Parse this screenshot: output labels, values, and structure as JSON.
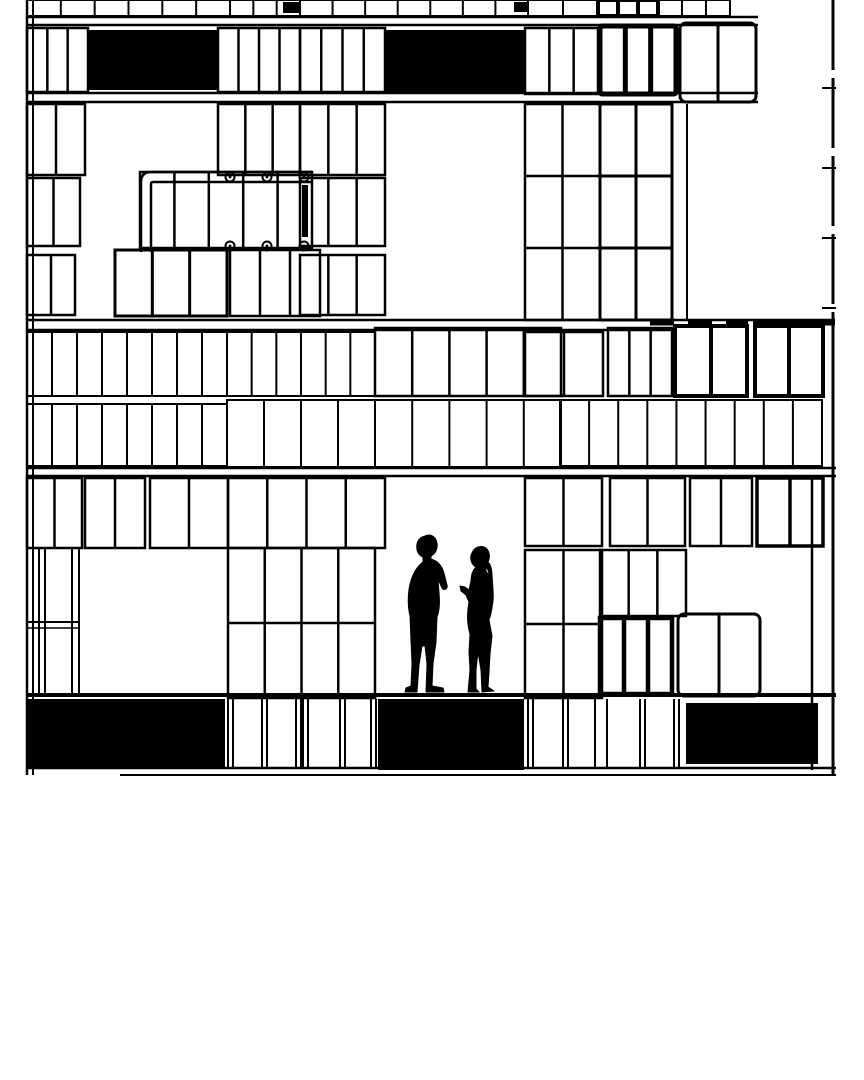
{
  "canvas": {
    "width": 864,
    "height": 1080,
    "paper_color": "#ffffff",
    "ink_color": "#000000"
  },
  "drawing": {
    "kind": "architectural-elevation",
    "black_panels": [
      [
        88,
        30,
        130,
        60
      ],
      [
        385,
        30,
        140,
        62
      ],
      [
        283,
        2,
        16,
        11
      ],
      [
        514,
        2,
        15,
        10
      ],
      [
        302,
        185,
        6,
        52
      ],
      [
        27,
        699,
        198,
        69
      ],
      [
        378,
        699,
        146,
        71
      ],
      [
        686,
        703,
        132,
        61
      ]
    ],
    "window_grids": [
      [
        27,
        0,
        203,
        16,
        6,
        1,
        2,
        0
      ],
      [
        230,
        0,
        70,
        16,
        3,
        1,
        2,
        0
      ],
      [
        300,
        0,
        228,
        16,
        7,
        1,
        2,
        0
      ],
      [
        528,
        0,
        70,
        16,
        2,
        1,
        2,
        0
      ],
      [
        598,
        0,
        60,
        16,
        3,
        1,
        4,
        0
      ],
      [
        658,
        0,
        72,
        16,
        3,
        1,
        2,
        0
      ],
      [
        27,
        28,
        61,
        64,
        3,
        1,
        2.5,
        0
      ],
      [
        218,
        28,
        82,
        64,
        4,
        1,
        2.5,
        0
      ],
      [
        300,
        28,
        85,
        64,
        4,
        1,
        2.5,
        0
      ],
      [
        525,
        28,
        73,
        66,
        3,
        1,
        2.5,
        0
      ],
      [
        600,
        26,
        76,
        68,
        3,
        1,
        5,
        2
      ],
      [
        680,
        23,
        76,
        79,
        2,
        1,
        3,
        6
      ],
      [
        525,
        104,
        75,
        216,
        2,
        3,
        2.5,
        0
      ],
      [
        600,
        104,
        72,
        216,
        2,
        3,
        3,
        0
      ],
      [
        27,
        104,
        58,
        71,
        2,
        1,
        2.5,
        0
      ],
      [
        218,
        104,
        82,
        71,
        3,
        1,
        2.5,
        0
      ],
      [
        300,
        104,
        85,
        71,
        3,
        1,
        2.5,
        0
      ],
      [
        27,
        178,
        53,
        68,
        2,
        1,
        2.5,
        0
      ],
      [
        140,
        172,
        172,
        76,
        5,
        1,
        2.5,
        0
      ],
      [
        300,
        178,
        85,
        68,
        3,
        1,
        2.5,
        0
      ],
      [
        27,
        255,
        48,
        60,
        2,
        1,
        2.5,
        0
      ],
      [
        115,
        250,
        112,
        66,
        3,
        1,
        3,
        0
      ],
      [
        230,
        250,
        90,
        66,
        3,
        1,
        2.5,
        0
      ],
      [
        300,
        255,
        85,
        60,
        3,
        1,
        2.5,
        0
      ],
      [
        27,
        332,
        200,
        64,
        8,
        1,
        2,
        0
      ],
      [
        227,
        332,
        148,
        64,
        6,
        1,
        2,
        0
      ],
      [
        375,
        328,
        186,
        68,
        5,
        1,
        2.5,
        0
      ],
      [
        525,
        332,
        78,
        64,
        2,
        1,
        2.5,
        0
      ],
      [
        608,
        328,
        64,
        68,
        3,
        1,
        2.5,
        0
      ],
      [
        675,
        326,
        72,
        70,
        2,
        1,
        4,
        0
      ],
      [
        755,
        326,
        68,
        70,
        2,
        1,
        4,
        0
      ],
      [
        27,
        404,
        200,
        62,
        8,
        1,
        2,
        0
      ],
      [
        227,
        400,
        148,
        67,
        4,
        1,
        2,
        0
      ],
      [
        375,
        400,
        186,
        67,
        5,
        1,
        2,
        0
      ],
      [
        560,
        400,
        262,
        66,
        9,
        1,
        2,
        0
      ],
      [
        27,
        478,
        55,
        70,
        2,
        1,
        2.5,
        0
      ],
      [
        85,
        478,
        60,
        70,
        2,
        1,
        2.5,
        0
      ],
      [
        150,
        478,
        78,
        70,
        2,
        1,
        2.5,
        0
      ],
      [
        228,
        478,
        157,
        70,
        4,
        1,
        2.5,
        0
      ],
      [
        525,
        478,
        77,
        68,
        2,
        1,
        2.5,
        0
      ],
      [
        610,
        478,
        75,
        68,
        2,
        1,
        2.5,
        0
      ],
      [
        690,
        478,
        62,
        68,
        2,
        1,
        2.5,
        0
      ],
      [
        757,
        478,
        66,
        68,
        2,
        1,
        3.5,
        0
      ],
      [
        228,
        548,
        147,
        150,
        4,
        2,
        2.5,
        0
      ],
      [
        525,
        550,
        77,
        148,
        2,
        2,
        2.5,
        0
      ],
      [
        600,
        550,
        86,
        66,
        3,
        1,
        2.5,
        0
      ],
      [
        600,
        618,
        72,
        76,
        3,
        1,
        4.5,
        0
      ],
      [
        678,
        614,
        82,
        82,
        2,
        1,
        3,
        6
      ]
    ],
    "hlines": [
      [
        27,
        17,
        758,
        2.5
      ],
      [
        27,
        25,
        758,
        2.5
      ],
      [
        27,
        93,
        758,
        2.5
      ],
      [
        27,
        102,
        758,
        2.5
      ],
      [
        27,
        320,
        835,
        2.5
      ],
      [
        27,
        330,
        672,
        2.5
      ],
      [
        753,
        323,
        835,
        5
      ],
      [
        27,
        468,
        836,
        2.5
      ],
      [
        27,
        476,
        836,
        2.5
      ],
      [
        27,
        622,
        80,
        2
      ],
      [
        27,
        628,
        80,
        1.5
      ],
      [
        27,
        695,
        836,
        4
      ],
      [
        27,
        768,
        836,
        2.5
      ],
      [
        120,
        775,
        836,
        2
      ],
      [
        822,
        88,
        836,
        2
      ],
      [
        822,
        168,
        836,
        2
      ],
      [
        822,
        238,
        836,
        2
      ],
      [
        822,
        308,
        836,
        2
      ]
    ],
    "vlines": [
      [
        27,
        0,
        775,
        2.5
      ],
      [
        33,
        0,
        775,
        2
      ],
      [
        39,
        548,
        697,
        2
      ],
      [
        45,
        548,
        697,
        2
      ],
      [
        72,
        548,
        697,
        2
      ],
      [
        79,
        548,
        697,
        2
      ],
      [
        687,
        104,
        320,
        2
      ],
      [
        812,
        478,
        770,
        2.5
      ],
      [
        833,
        312,
        775,
        3
      ],
      [
        228,
        699,
        768,
        2
      ],
      [
        233,
        699,
        768,
        2
      ],
      [
        262,
        699,
        768,
        2
      ],
      [
        267,
        699,
        768,
        2
      ],
      [
        296,
        699,
        768,
        2
      ],
      [
        301,
        699,
        768,
        2
      ],
      [
        303,
        699,
        768,
        2
      ],
      [
        308,
        699,
        768,
        2
      ],
      [
        340,
        699,
        768,
        2
      ],
      [
        345,
        699,
        768,
        2
      ],
      [
        371,
        699,
        768,
        2
      ],
      [
        376,
        699,
        768,
        2
      ],
      [
        528,
        699,
        768,
        2
      ],
      [
        533,
        699,
        768,
        2
      ],
      [
        563,
        699,
        768,
        2
      ],
      [
        568,
        699,
        768,
        2
      ],
      [
        595,
        699,
        768,
        2
      ],
      [
        607,
        699,
        768,
        2
      ],
      [
        640,
        699,
        768,
        2
      ],
      [
        645,
        699,
        768,
        2
      ],
      [
        674,
        699,
        768,
        2
      ],
      [
        679,
        699,
        768,
        2
      ]
    ],
    "dashed_hlines": [
      [
        650,
        323,
        748,
        5,
        "24 14"
      ]
    ],
    "dashed_vlines": [
      [
        833,
        0,
        312,
        3,
        "70 8"
      ]
    ],
    "screw_circles": [
      [
        230,
        177
      ],
      [
        267,
        177
      ],
      [
        304,
        177
      ],
      [
        230,
        246
      ],
      [
        267,
        246
      ],
      [
        304,
        246
      ]
    ],
    "pipe_paths": [
      "M141,252 L141,182 Q141,172 151,172 L312,172",
      "M151,252 L151,184 Q151,182 153,182 L312,182"
    ],
    "figures": [
      {
        "name": "man-silhouette",
        "head": [
          426,
          545,
          8.5
        ],
        "path": "M425,536 C431,533 436,537 437,543 C438,549 435,554 431,556 L431,559 C438,561 442,566 444,573 L447,585 C448,589 444,591 442,588 L438,579 L439,593 C440,603 439,612 437,617 L436,642 L433,664 L432,686 L443,688 L444,692 L426,692 L427,664 L425,646 L422,646 L419,665 L417,692 L405,692 L406,688 L411,686 L412,663 L411,641 L410,616 C408,608 408,597 409,589 C411,577 416,567 423,562 L423,557 C418,555 416,550 417,544 C418,539 421,537 425,536 Z"
      },
      {
        "name": "woman-silhouette",
        "head": [
          479,
          558,
          7.5
        ],
        "path": "M473,551 C476,546 483,545 487,549 C490,553 490,558 488,562 C491,565 492,570 492,575 L493,589 L490,589 L489,576 C489,572 488,569 486,567 L486,571 C492,579 494,591 493,601 C492,609 491,615 489,620 L492,636 L490,654 L489,672 L488,687 L494,691 L482,692 L481,670 L478,652 L476,670 L476,689 L479,692 L468,692 L470,670 L469,652 L470,634 C467,624 467,612 469,602 L466,595 L461,591 L460,586 L465,587 L469,590 L471,581 C471,575 473,570 476,567 C472,565 470,560 471,555 Z"
      }
    ]
  }
}
